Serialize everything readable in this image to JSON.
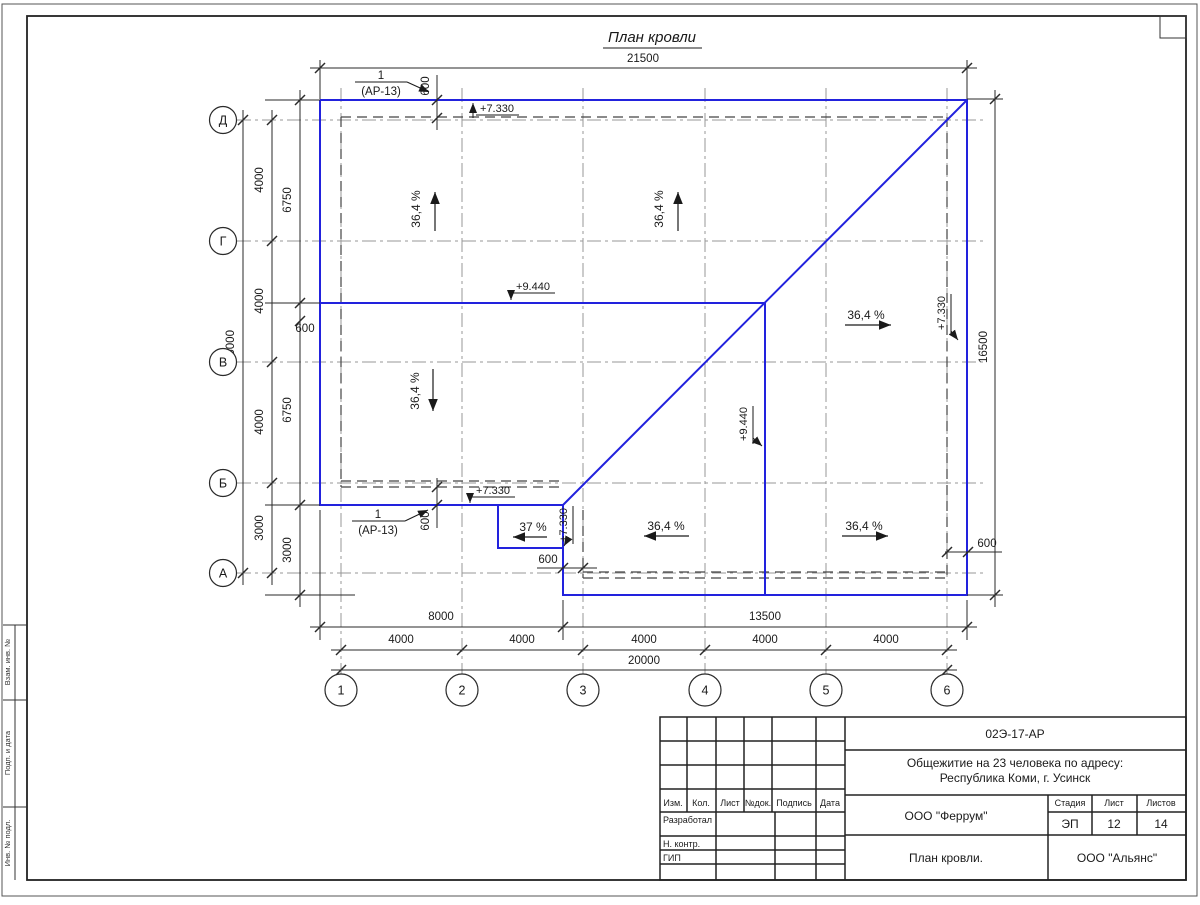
{
  "title": "План кровли",
  "callout": {
    "num": "1",
    "ref": "(АР-13)"
  },
  "labels": {
    "slope": "36,4 %",
    "slope_small": "37 %",
    "elev_high": "+9.440",
    "elev_low": "+7.330"
  },
  "dims": {
    "d21500": "21500",
    "d15000": "15000",
    "d16500": "16500",
    "d20000": "20000",
    "d13500": "13500",
    "d8000": "8000",
    "d6750": "6750",
    "d4000": "4000",
    "d3000": "3000",
    "d600": "600"
  },
  "axes": {
    "rows": [
      "Д",
      "Г",
      "В",
      "Б",
      "А"
    ],
    "cols": [
      "1",
      "2",
      "3",
      "4",
      "5",
      "6"
    ]
  },
  "frame": {
    "strip": [
      "Взам. инв. №",
      "Подп. и дата",
      "Инв. № подл."
    ]
  },
  "titleblock": {
    "code": "02Э-17-АР",
    "object1": "Общежитие на 23 человека по адресу:",
    "object2": "Республика Коми, г. Усинск",
    "col_izm": "Изм.",
    "col_kol": "Кол.",
    "col_list": "Лист",
    "col_ndok": "№док.",
    "col_podpis": "Подпись",
    "col_data": "Дата",
    "row_dev": "Разработал",
    "row_ncontr": "Н. контр.",
    "row_gip": "ГИП",
    "stage_label": "Стадия",
    "list_label": "Лист",
    "listov_label": "Листов",
    "stage": "ЭП",
    "list_no": "12",
    "listov": "14",
    "org": "ООО \"Феррум\"",
    "sheet_title": "План кровли.",
    "org2": "ООО \"Альянс\""
  },
  "colors": {
    "roof": "#2222dd"
  }
}
